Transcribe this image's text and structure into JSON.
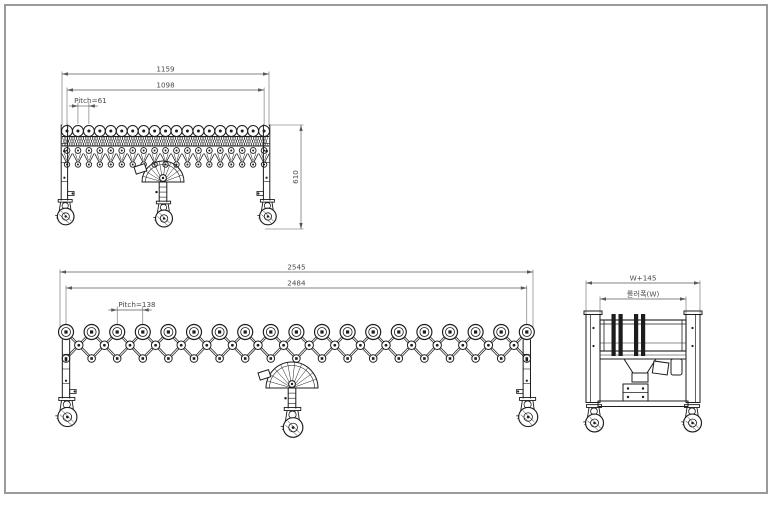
{
  "sheet": {
    "background": "#ffffff",
    "frame_color": "#9a9a9a",
    "line_color": "#1c1c1c",
    "dim_color": "#5a5a5a",
    "text_color": "#4a4a4a"
  },
  "views": {
    "retracted": {
      "roller_count": 19,
      "dim_overall": "1159",
      "dim_roller_span": "1098",
      "dim_pitch": "Pitch=61",
      "dim_height": "610"
    },
    "extended": {
      "roller_count": 19,
      "dim_overall": "2545",
      "dim_roller_span": "2484",
      "dim_pitch": "Pitch=138"
    },
    "end": {
      "dim_overall": "W+145",
      "dim_roller_width": "롤러폭(W)"
    }
  }
}
